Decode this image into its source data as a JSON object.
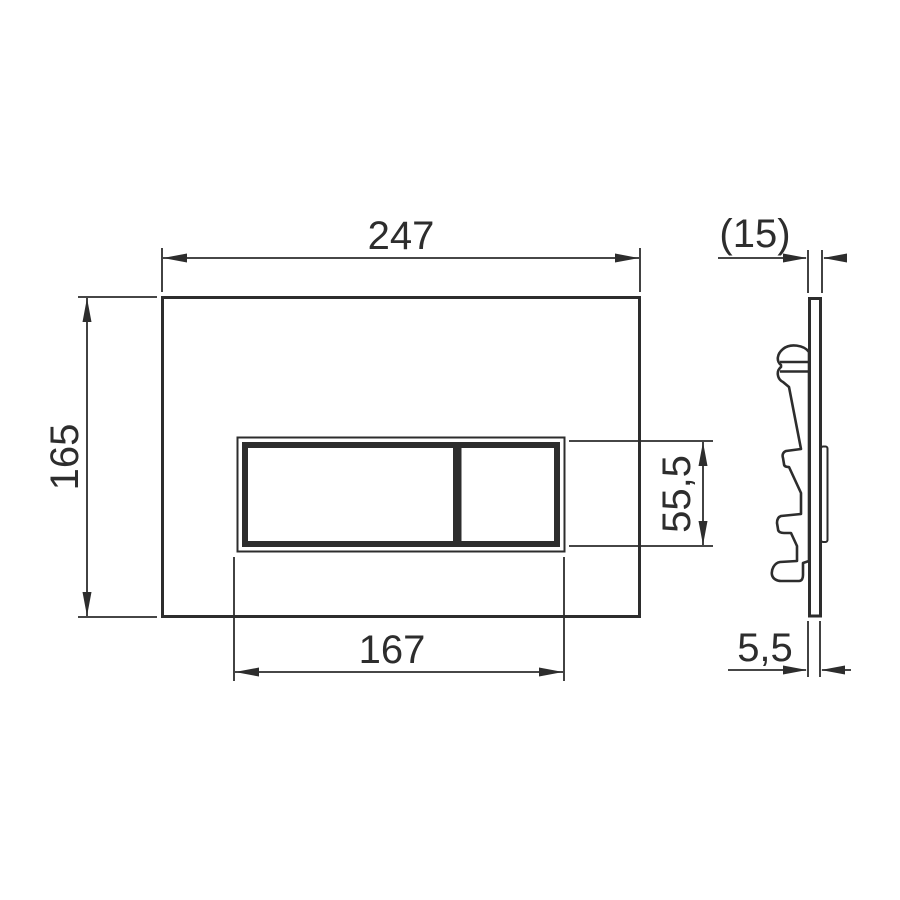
{
  "drawing": {
    "subject": "flush-plate-technical-drawing",
    "line_color": "#2d2d2d",
    "background": "#ffffff",
    "dimensions": {
      "front_width": "247",
      "front_height": "165",
      "button_panel_width": "167",
      "button_panel_height": "55,5",
      "side_depth": "(15)",
      "side_thickness": "5,5"
    }
  }
}
